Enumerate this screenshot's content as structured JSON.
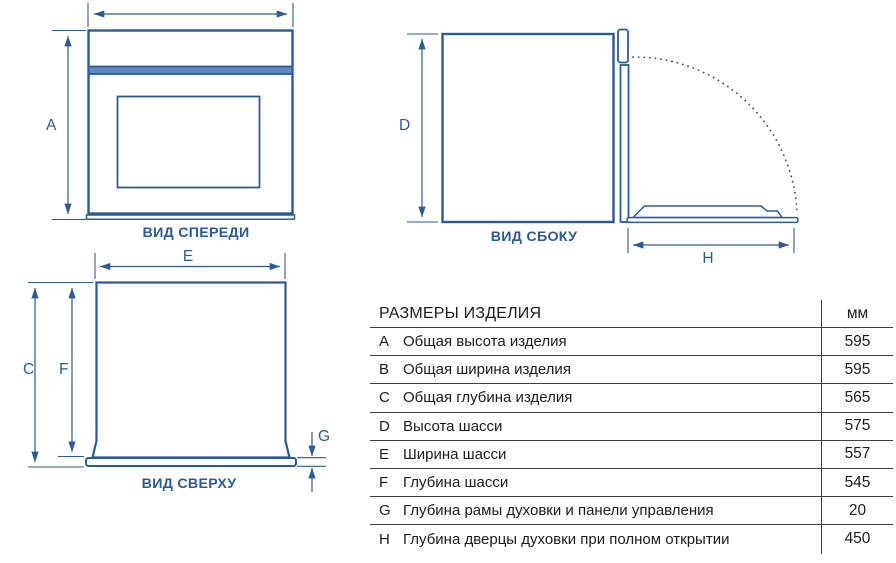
{
  "figure_title": "Габаритные размеры духового шкафа",
  "colors": {
    "diagram_line": "#2b5b97",
    "band_fill": "#6089bd",
    "door_swing_arc": "#44505e",
    "table_text": "#1c1c1c",
    "table_line": "#3f3f3f",
    "background": "#ffffff"
  },
  "views": {
    "front": {
      "caption": "ВИД СПЕРЕДИ",
      "height_letter": "A"
    },
    "side": {
      "caption": "ВИД СБОКУ",
      "height_letter": "D",
      "door_letter": "H"
    },
    "top": {
      "caption": "ВИД СВЕРХУ",
      "width_letter": "E",
      "overall_depth_letter": "C",
      "chassis_depth_letter": "F",
      "frame_letter": "G"
    }
  },
  "table": {
    "title": "РАЗМЕРЫ ИЗДЕЛИЯ",
    "unit_header": "мм",
    "rows": [
      {
        "key": "A",
        "label": "Общая высота изделия",
        "value": "595"
      },
      {
        "key": "B",
        "label": "Общая ширина изделия",
        "value": "595"
      },
      {
        "key": "C",
        "label": "Общая глубина изделия",
        "value": "565"
      },
      {
        "key": "D",
        "label": "Высота шасси",
        "value": "575"
      },
      {
        "key": "E",
        "label": "Ширина шасси",
        "value": "557"
      },
      {
        "key": "F",
        "label": "Глубина шасси",
        "value": "545"
      },
      {
        "key": "G",
        "label": "Глубина рамы духовки и панели управления",
        "value": "20"
      },
      {
        "key": "H",
        "label": "Глубина дверцы духовки при полном открытии",
        "value": "450"
      }
    ]
  }
}
